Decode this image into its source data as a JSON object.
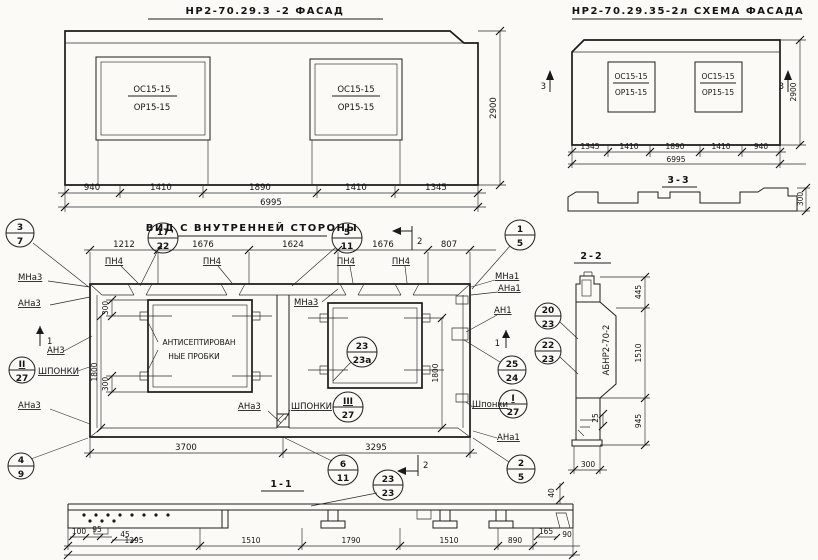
{
  "facade": {
    "title": "НР2-70.29.3 -2  ФАСАД",
    "window_top": "ОС15-15",
    "window_bottom": "ОР15-15",
    "dims": [
      "940",
      "1410",
      "1890",
      "1410",
      "1345"
    ],
    "total": "6995",
    "height": "2900"
  },
  "schema": {
    "title": "НР2-70.29.35-2л  СХЕМА ФАСАДА",
    "window_top": "ОС15-15",
    "window_bottom": "ОР15-15",
    "dims": [
      "1345",
      "1410",
      "1890",
      "1410",
      "940"
    ],
    "total": "6995",
    "height": "2900",
    "cut_mark": "3",
    "section_title": "3-3",
    "section_thickness": "300"
  },
  "view": {
    "title": "ВИД С ВНУТРЕННЕЙ СТОРОНЫ",
    "dims_top": [
      "1212",
      "1676",
      "1624",
      "1676",
      "807"
    ],
    "dims_bottom": [
      "3700",
      "3295"
    ],
    "pn_label": "ПН4",
    "note_line1": "АНТИСЕПТИРОВАН",
    "note_line2": "НЫЕ ПРОБКИ",
    "shponki": "ШПОНКИ",
    "shponki_cap": "Шпонки",
    "dim_300": "300",
    "dim_1800": "1800",
    "labels": {
      "mna3": "МНа3",
      "ana3": "АНа3",
      "an3": "АН3",
      "mna1": "МНа1",
      "ana1": "АНа1",
      "an1": "АН1"
    },
    "cut_1": "1",
    "cut_2": "2",
    "section_title": "1-1"
  },
  "section22": {
    "title": "2-2",
    "panel_mark": "АБНР2-70-2",
    "dim_top": "445",
    "dim_mid": "1510",
    "dim_bottom": "945",
    "dim_step": "25",
    "dim_width": "300"
  },
  "section11": {
    "dims_left": [
      "100",
      "95",
      "45"
    ],
    "dims_main": [
      "1295",
      "1510",
      "1790",
      "1510",
      "890"
    ],
    "dims_right": [
      "165",
      "90"
    ],
    "dim_edge": "40"
  },
  "callouts": {
    "c3_7": {
      "top": "3",
      "bottom": "7"
    },
    "c17_22": {
      "top": "17",
      "bottom": "22"
    },
    "c5_11": {
      "top": "5",
      "bottom": "11"
    },
    "c1_5": {
      "top": "1",
      "bottom": "5"
    },
    "c2_27": {
      "top": "II",
      "bottom": "27"
    },
    "c4_9": {
      "top": "4",
      "bottom": "9"
    },
    "c23_23a": {
      "top": "23",
      "bottom": "23а"
    },
    "c25_24": {
      "top": "25",
      "bottom": "24"
    },
    "c1_27": {
      "top": "I",
      "bottom": "27"
    },
    "c3_27": {
      "top": "III",
      "bottom": "27"
    },
    "c20_23": {
      "top": "20",
      "bottom": "23"
    },
    "c22_23": {
      "top": "22",
      "bottom": "23"
    },
    "c6_11": {
      "top": "6",
      "bottom": "11"
    },
    "c2_5": {
      "top": "2",
      "bottom": "5"
    },
    "c23_23": {
      "top": "23",
      "bottom": "23"
    }
  }
}
